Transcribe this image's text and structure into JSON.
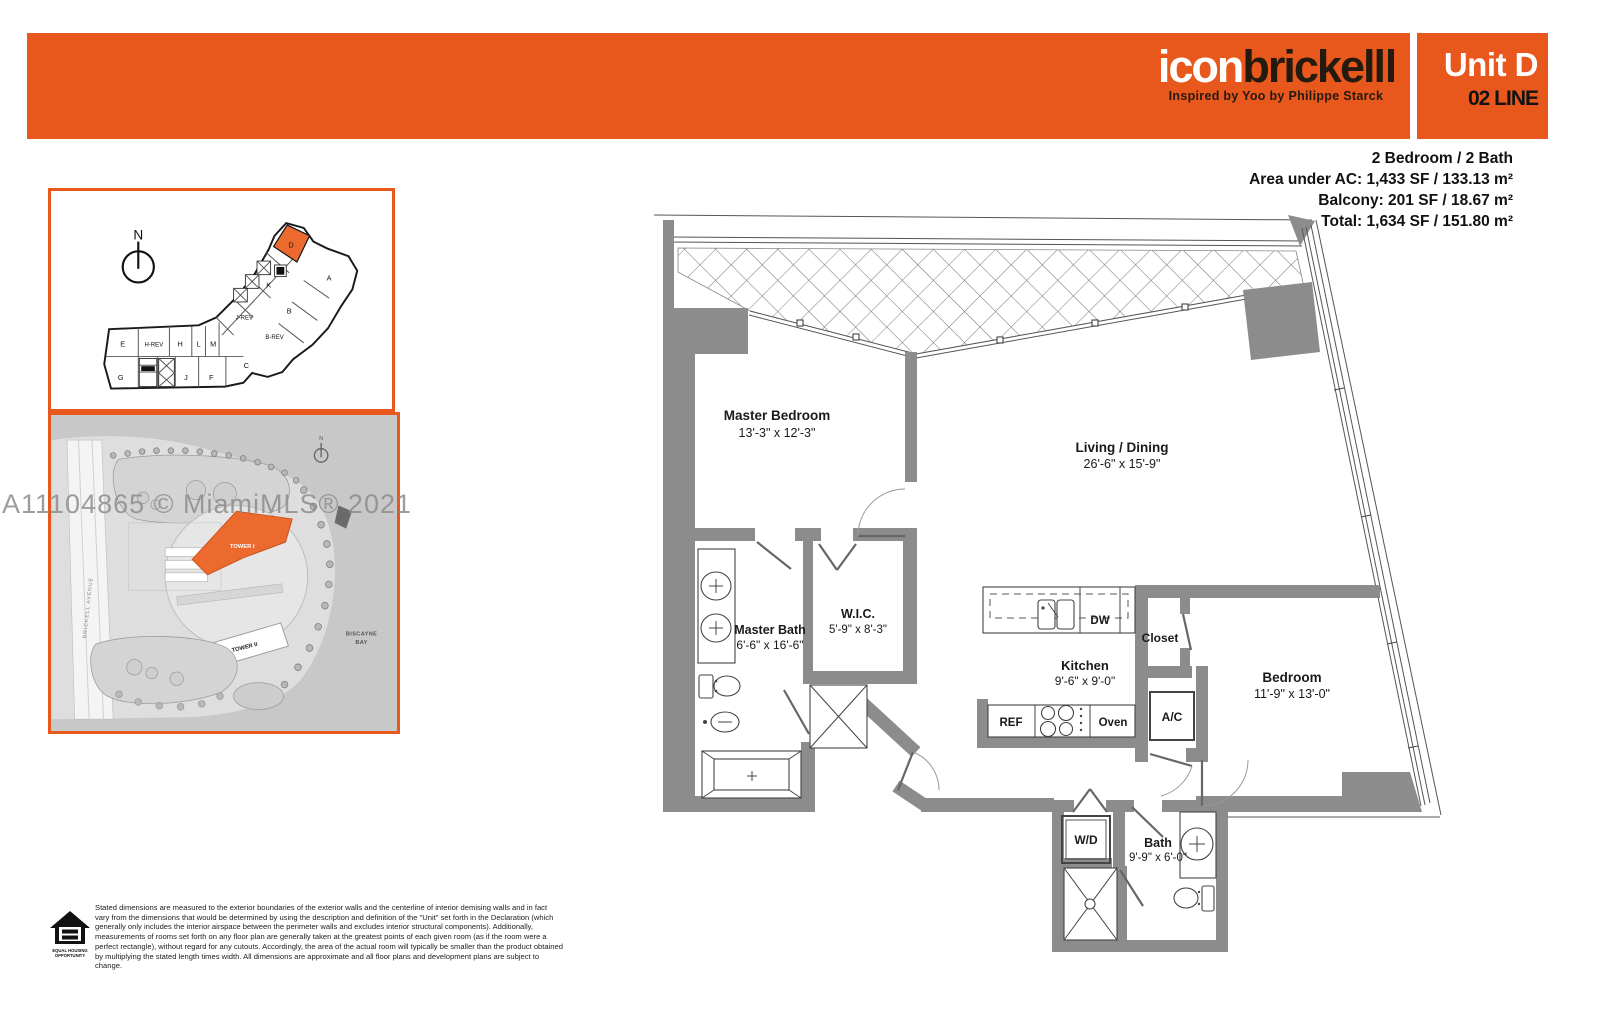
{
  "header": {
    "brand_part1": "icon",
    "brand_part2": "brickell",
    "tagline": "Inspired by Yoo by Philippe Starck",
    "unit": "Unit D",
    "line": "02 LINE"
  },
  "summary": {
    "line1": "2 Bedroom / 2 Bath",
    "line2": "Area under AC: 1,433 SF / 133.13 m²",
    "line3": "Balcony: 201 SF / 18.67 m²",
    "line4": "Total: 1,634 SF / 151.80 m²"
  },
  "keyplan": {
    "compass_label": "N",
    "highlighted_unit": "D",
    "units": [
      "D",
      "K",
      "A",
      "B",
      "J-REV",
      "B-REV",
      "E",
      "H-REV",
      "H",
      "L",
      "M",
      "C",
      "G",
      "J",
      "F"
    ]
  },
  "sitemap": {
    "tower1": "TOWER I",
    "tower2": "TOWER II",
    "bay_line1": "BISCAYNE",
    "bay_line2": "BAY",
    "street": "BRICKELL AVENUE",
    "compass_label": "N"
  },
  "watermark": "A11104865 © MiamiMLS® 2021",
  "floorplan": {
    "rooms": {
      "master_bedroom": {
        "name": "Master Bedroom",
        "dims": "13'-3\" x 12'-3\""
      },
      "living_dining": {
        "name": "Living / Dining",
        "dims": "26'-6\" x 15'-9\""
      },
      "master_bath": {
        "name": "Master Bath",
        "dims": "6'-6\" x 16'-6\""
      },
      "wic": {
        "name": "W.I.C.",
        "dims": "5'-9\" x 8'-3\""
      },
      "kitchen": {
        "name": "Kitchen",
        "dims": "9'-6\" x 9'-0\""
      },
      "bedroom": {
        "name": "Bedroom",
        "dims": "11'-9\" x 13'-0\""
      },
      "bath": {
        "name": "Bath",
        "dims": "9'-9\" x 6'-0\""
      },
      "closet": "Closet",
      "ac": "A/C",
      "wd": "W/D",
      "ref": "REF",
      "dw": "DW",
      "oven": "Oven"
    }
  },
  "disclaimer": "Stated dimensions are measured to the exterior boundaries of the exterior walls and the centerline of interior demising walls and in fact vary from the dimensions that would be determined by using the description and definition of the \"Unit\" set forth in the Declaration (which generally only includes the interior airspace between the perimeter walls and excludes interior structural components). Additionally, measurements of rooms set forth on any floor plan are generally taken at the greatest points of each given room (as if the room were a perfect rectangle), without regard for any cutouts. Accordingly, the area of the actual room will typically be smaller than the product obtained by multiplying the stated length times width. All dimensions are approximate and all floor plans and development plans are subject to change.",
  "equal_housing": {
    "line1": "EQUAL HOUSING",
    "line2": "OPPORTUNITY"
  },
  "colors": {
    "orange": "#e8581c",
    "tower_orange": "#ed6a2f",
    "wall_gray": "#8c8c8c"
  }
}
